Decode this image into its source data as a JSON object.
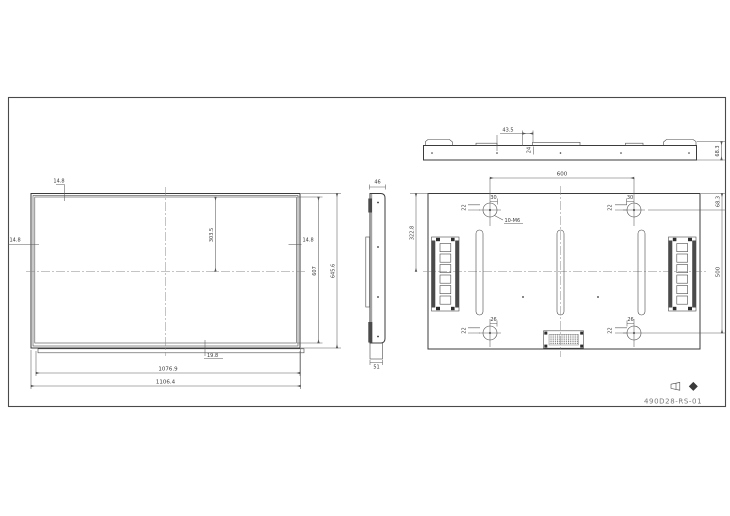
{
  "title_block": {
    "drawing_number": "490D28-RS-01"
  },
  "front_view": {
    "top_bezel": "14.8",
    "left_bezel": "14.8",
    "right_bezel": "14.8",
    "half_inner_height": "303.5",
    "inner_height": "607",
    "overall_height": "645.6",
    "bottom_bezel": "19.8",
    "inner_width": "1076.9",
    "overall_width": "1106.4"
  },
  "side_view": {
    "top_thickness": "46",
    "bottom_thickness": "51"
  },
  "top_view": {
    "handle_offset": "43.5",
    "handle_depth": "24",
    "overall_depth": "68.3"
  },
  "rear_view": {
    "mount_hole_spacing_h": "600",
    "mount_hole_spacing_v": "500",
    "hole_to_top_edge": "68.3",
    "top_to_centerline": "322.8",
    "hole_offset_top": "30",
    "hole_offset_bottom": "26",
    "hole_offset_side": "22",
    "mount_hole_spec": "10-M6"
  }
}
